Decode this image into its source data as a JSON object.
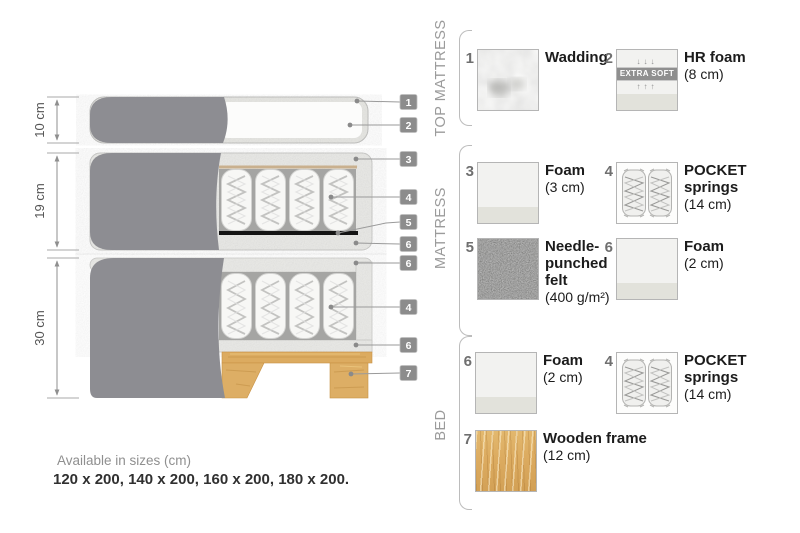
{
  "title": "Bed construction cross-section infographic",
  "colors": {
    "fabric_gray": "#8d8d92",
    "casing_gray": "#e9e9e6",
    "spring_shadow": "#a5a5a3",
    "felt_black": "#141414",
    "wood_tan": "#dcab60",
    "tag_bg": "#8c8c8c",
    "leader_gray": "#9a9a9a",
    "text_dark": "#1c1c1c",
    "text_muted": "#8f8f8f"
  },
  "diagram": {
    "dimensions": [
      {
        "label": "10 cm"
      },
      {
        "label": "19 cm"
      },
      {
        "label": "30 cm"
      }
    ],
    "tags": [
      {
        "n": "1"
      },
      {
        "n": "2"
      },
      {
        "n": "3"
      },
      {
        "n": "4"
      },
      {
        "n": "5"
      },
      {
        "n": "6"
      },
      {
        "n": "6"
      },
      {
        "n": "4"
      },
      {
        "n": "6"
      },
      {
        "n": "7"
      }
    ]
  },
  "legend": {
    "sections": [
      {
        "title": "TOP MATTRESS",
        "items": [
          {
            "num": "1",
            "name": "Wadding",
            "detail": "",
            "swatch": "wadding"
          },
          {
            "num": "2",
            "name": "HR foam",
            "detail": "(8 cm)",
            "swatch": "foam-extra-soft",
            "badge": "EXTRA SOFT",
            "arrows_down": "↓↓↓",
            "arrows_up": "↑↑↑"
          }
        ]
      },
      {
        "title": "MATTRESS",
        "items": [
          {
            "num": "3",
            "name": "Foam",
            "detail": "(3 cm)",
            "swatch": "foam"
          },
          {
            "num": "4",
            "name": "POCKET springs",
            "detail": "(14 cm)",
            "swatch": "pocket-springs"
          },
          {
            "num": "5",
            "name": "Needle-punched felt",
            "detail": "(400 g/m²)",
            "swatch": "felt"
          },
          {
            "num": "6",
            "name": "Foam",
            "detail": "(2 cm)",
            "swatch": "foam"
          }
        ]
      },
      {
        "title": "BED",
        "items": [
          {
            "num": "6",
            "name": "Foam",
            "detail": "(2 cm)",
            "swatch": "foam"
          },
          {
            "num": "4",
            "name": "POCKET springs",
            "detail": "(14 cm)",
            "swatch": "pocket-springs"
          },
          {
            "num": "7",
            "name": "Wooden frame",
            "detail": "(12 cm)",
            "swatch": "wood"
          }
        ]
      }
    ]
  },
  "footer": {
    "availability": "Available in sizes (cm)",
    "sizes": "120 x 200, 140 x 200, 160 x 200, 180 x 200."
  }
}
